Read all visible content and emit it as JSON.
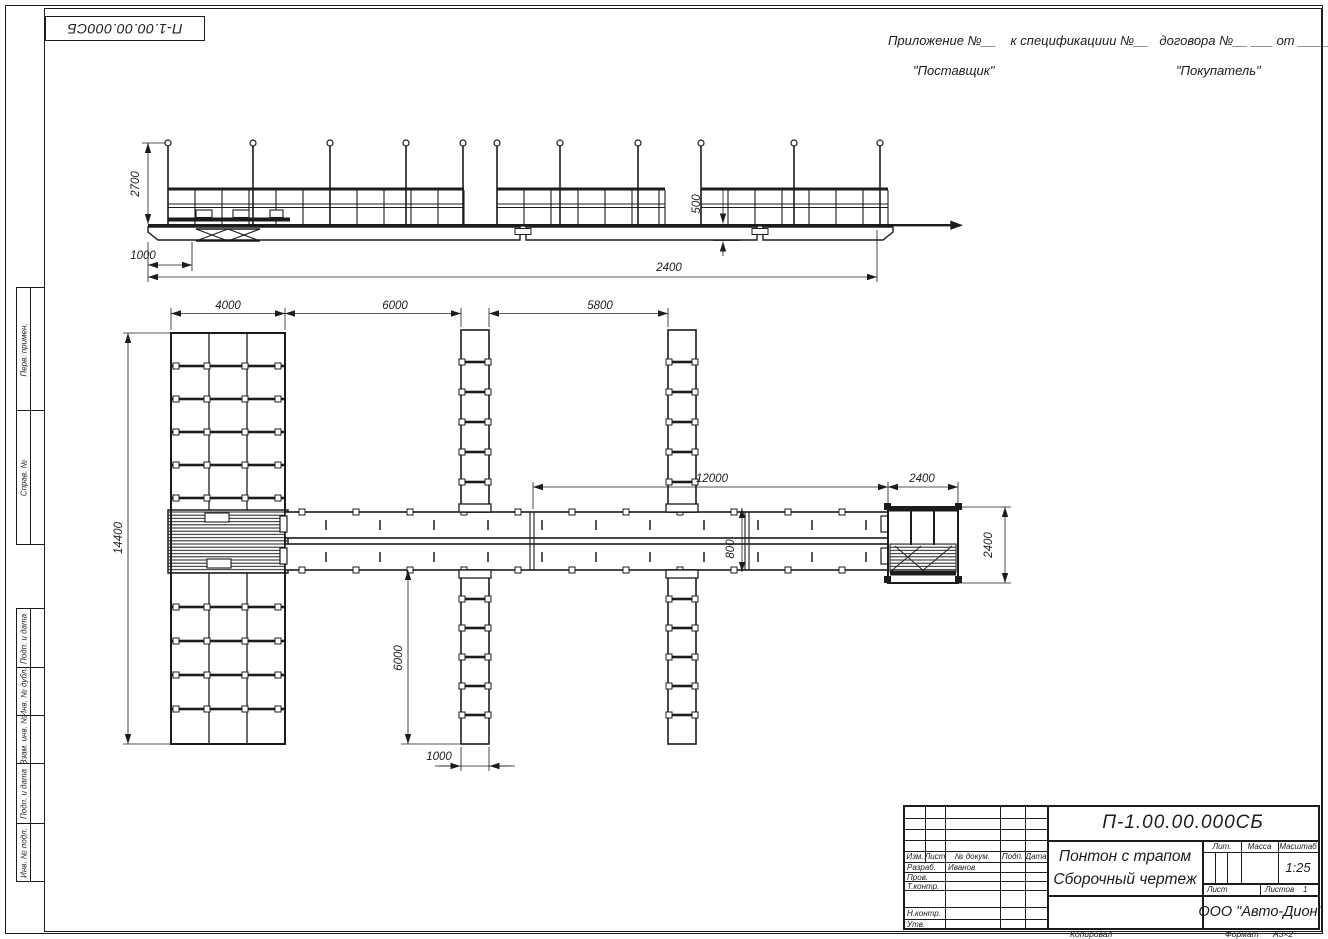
{
  "sheet": {
    "doc_number_top": "П-1.00.00.000СБ",
    "copied_label": "Копировал",
    "format_label": "Формат",
    "format_value": "А3×2"
  },
  "header": {
    "appendix_line": "Приложение №__    к спецификациии №__   договора №__ ___ от ________",
    "supplier_label": "\"Поставщик\"",
    "buyer_label": "\"Покупатель\""
  },
  "frame_columns": {
    "items": [
      "Перв. примен.",
      "Справ. №",
      "Подп. и дата",
      "Инв. № дубл.",
      "Взам. инв. №",
      "Подп. и дата",
      "Инв. № подл."
    ]
  },
  "title_block": {
    "doc_number": "П-1.00.00.000СБ",
    "title_line1": "Понтон с трапом",
    "title_line2": "Сборочный чертеж",
    "company": "ООО \"Авто-Дион\"",
    "header_cols": [
      "Изм.",
      "Лист",
      "№ докум.",
      "Подп.",
      "Дата"
    ],
    "roles": [
      "Разраб.",
      "Пров.",
      "Т.контр.",
      "Н.контр.",
      "Утв."
    ],
    "developer_name": "Иванов",
    "lit_label": "Лит.",
    "mass_label": "Масса",
    "scale_label": "Масштаб",
    "scale_value": "1:25",
    "sheet_label": "Лист",
    "sheets_label": "Листов",
    "sheets_value": "1"
  },
  "dims": {
    "elev_height": "2700",
    "elev_offset": "1000",
    "elev_length": "2400",
    "elev_freeboard": "500",
    "plan_pier_width": "4000",
    "plan_bay1": "6000",
    "plan_bay2": "5800",
    "plan_walkway_len": "12000",
    "plan_platform_w": "2400",
    "plan_pier_length": "14400",
    "plan_finger_len": "6000",
    "plan_finger_w": "1000",
    "plan_walkway_w": "800",
    "plan_platform_h": "2400"
  }
}
